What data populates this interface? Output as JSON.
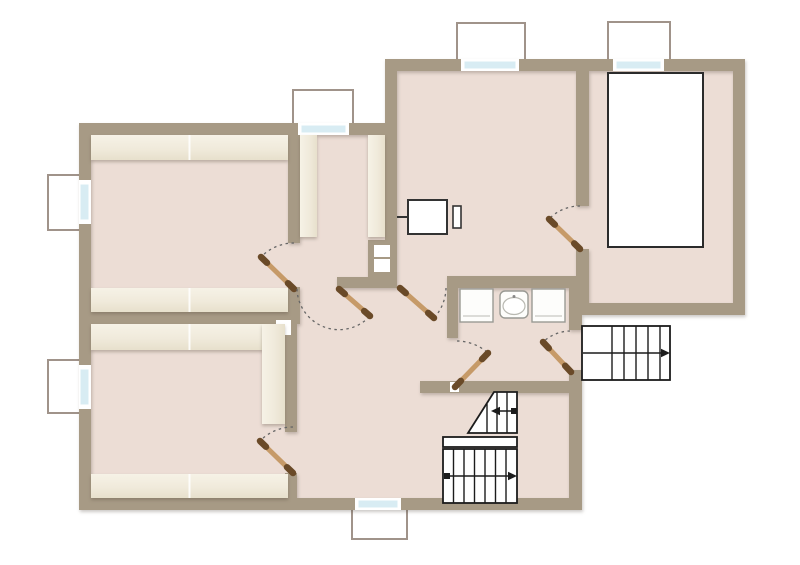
{
  "palette": {
    "background": "#ffffff",
    "wall": "#a79a85",
    "floor": "#ecddd5",
    "band_light": "#f5f1e4",
    "band_dark": "#e7e0cc",
    "window_glass": "#d8ecf3",
    "window_frame": "#ffffff",
    "well_border": "#a0938a",
    "stair_line": "#1c1c1c",
    "door_leaf": "#c69a68",
    "door_leaf_tip": "#6a4a28",
    "door_arc": "#666666",
    "fixture_border": "#333333",
    "appliance_border": "#9a9a94",
    "fixture_fill": "#ffffff"
  },
  "plan": {
    "type": "floor-plan",
    "counts": {
      "doors": 7,
      "windows": 6,
      "window_wells": 6,
      "staircases": 2,
      "appliances": 2,
      "sinks": 1,
      "chimney_flues": 2,
      "large_fixtures": 1,
      "furnaces": 1
    },
    "stair_arrows": {
      "exterior_stair": "right",
      "interior_upper_flight": "left",
      "interior_lower_flight": "right"
    }
  }
}
